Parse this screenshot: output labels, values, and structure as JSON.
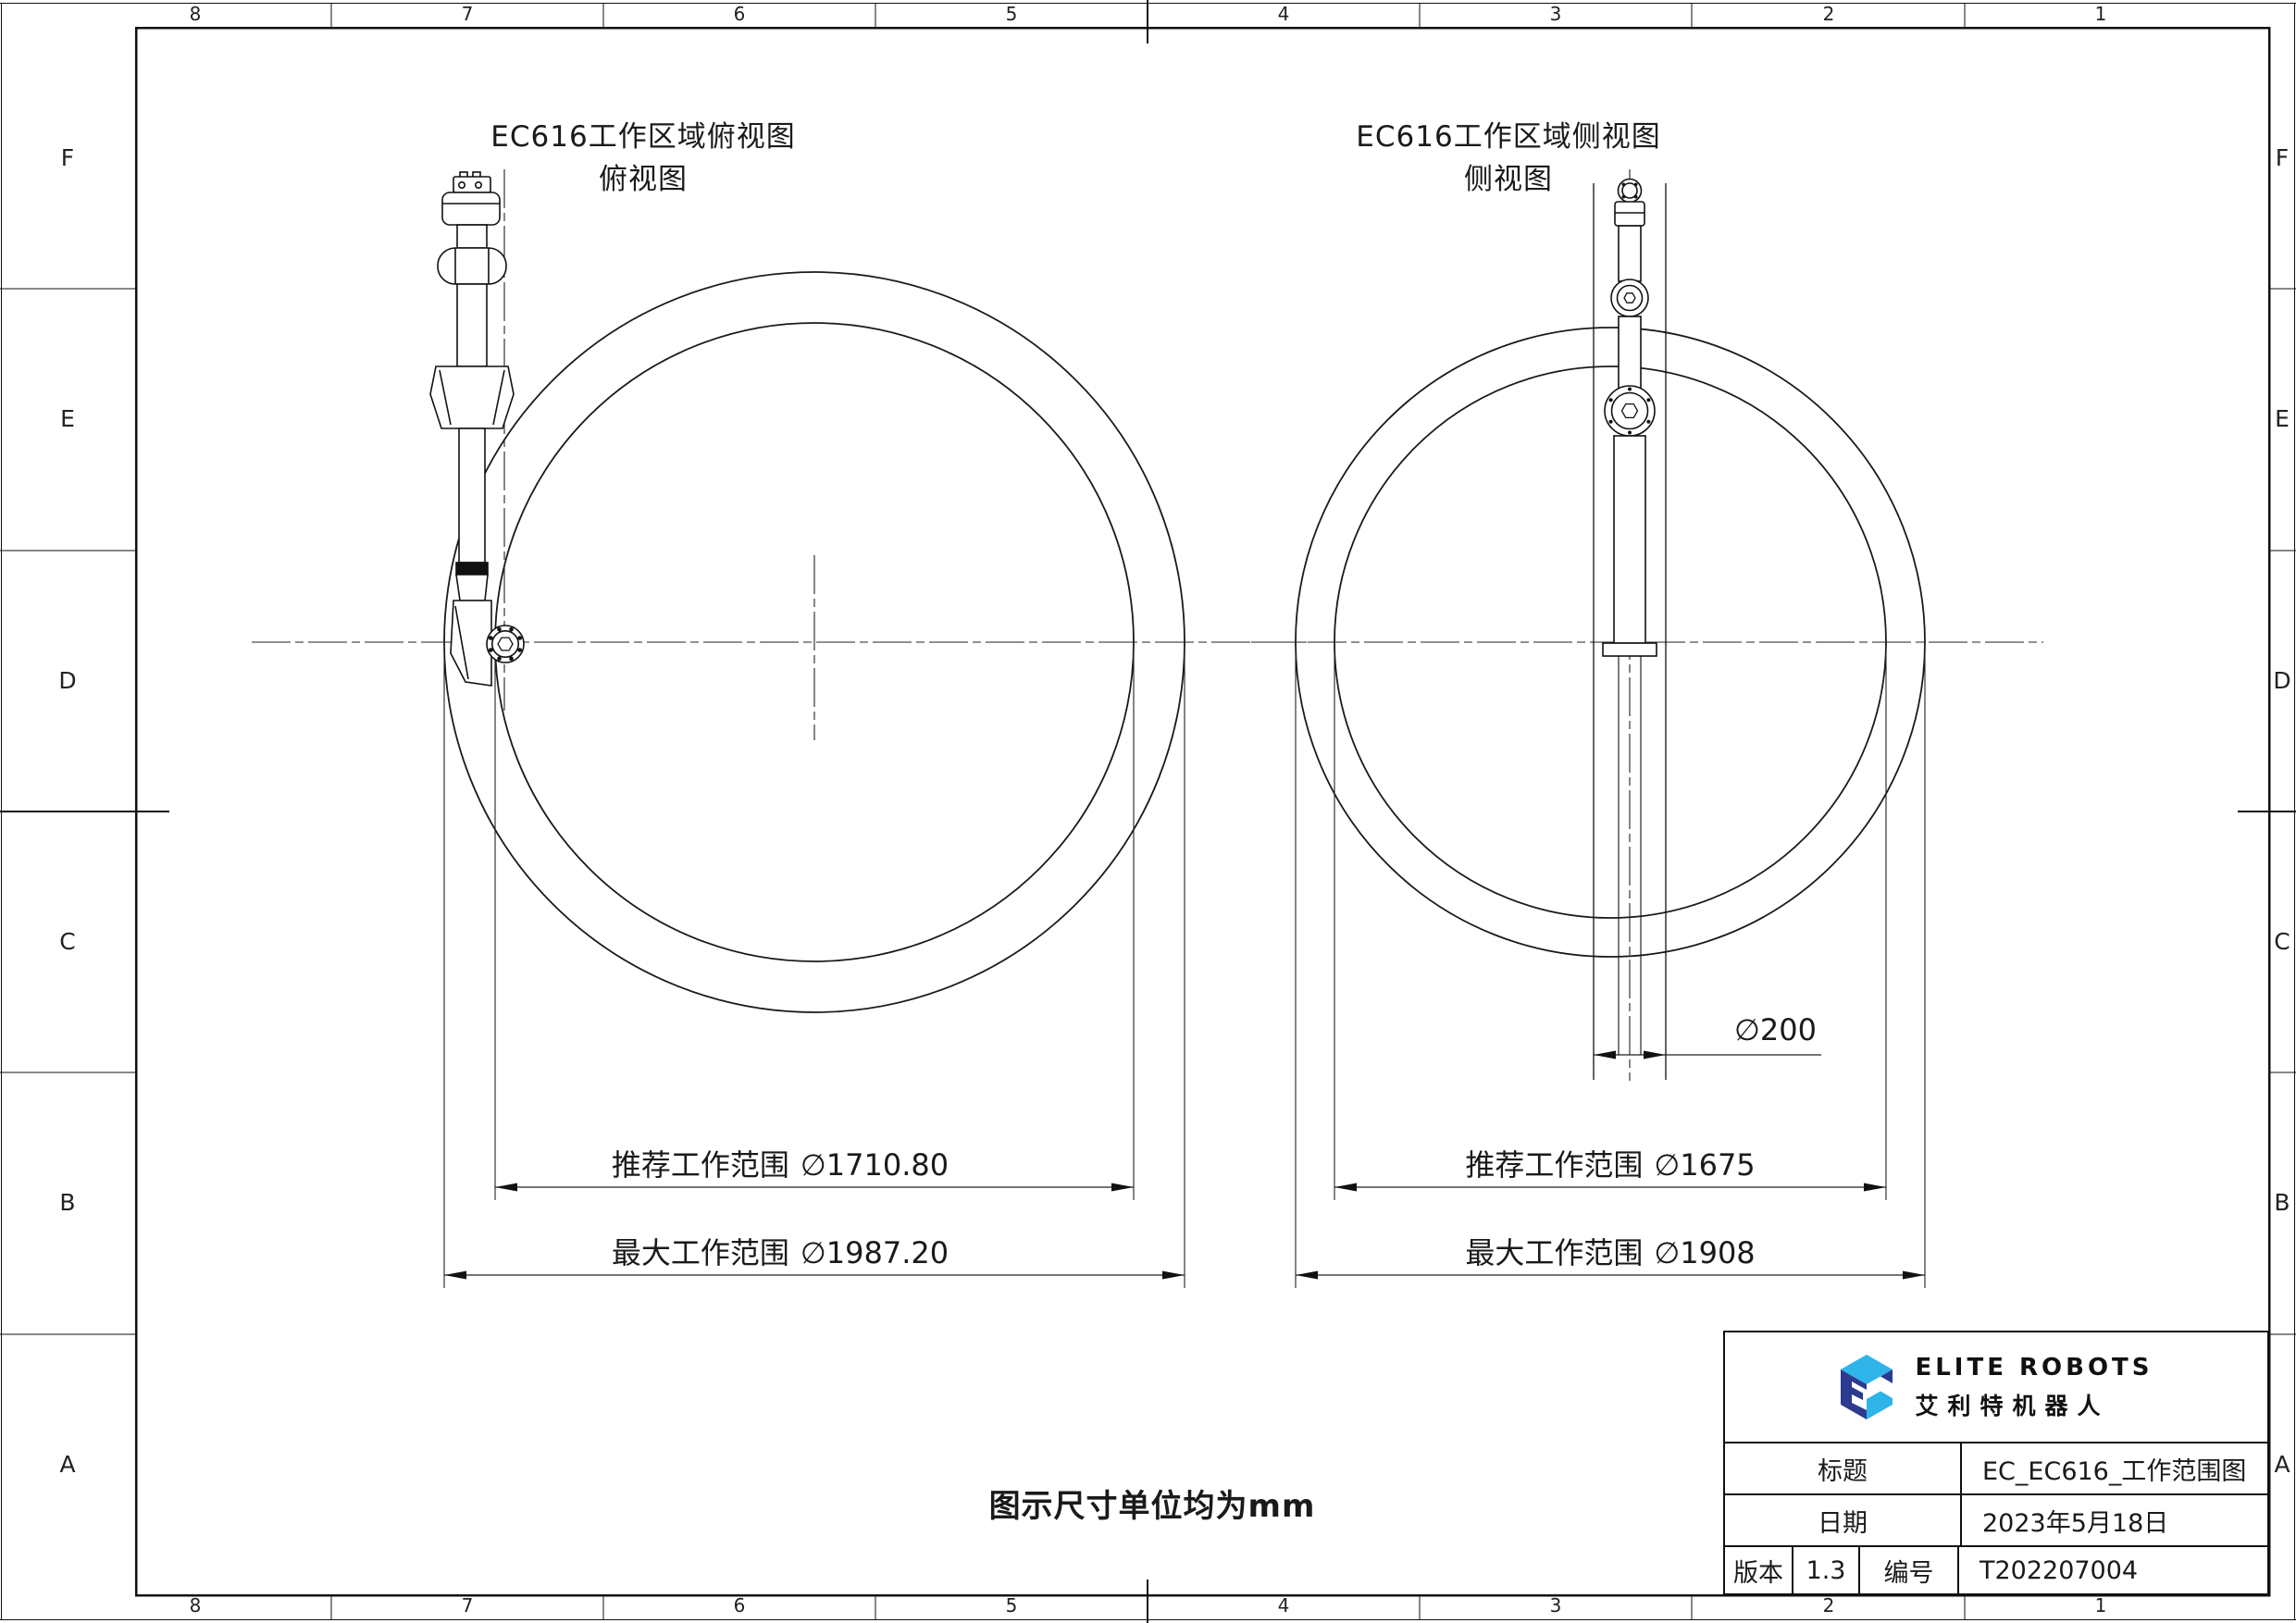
{
  "sheet": {
    "zones_top": [
      "8",
      "7",
      "6",
      "5",
      "4",
      "3",
      "2",
      "1"
    ],
    "zones_bottom": [
      "8",
      "7",
      "6",
      "5",
      "4",
      "3",
      "2",
      "1"
    ],
    "zones_left": [
      "F",
      "E",
      "D",
      "C",
      "B",
      "A"
    ],
    "zones_right": [
      "F",
      "E",
      "D",
      "C",
      "B",
      "A"
    ],
    "note": "图示尺寸单位均为mm"
  },
  "top_view": {
    "title": "EC616工作区域俯视图",
    "subtitle": "俯视图",
    "dim_recommended_label": "推荐工作范围",
    "dim_recommended_value": "∅1710.80",
    "dim_max_label": "最大工作范围",
    "dim_max_value": "∅1987.20"
  },
  "side_view": {
    "title": "EC616工作区域侧视图",
    "subtitle": "侧视图",
    "dim_recommended_label": "推荐工作范围",
    "dim_recommended_value": "∅1675",
    "dim_max_label": "最大工作范围",
    "dim_max_value": "∅1908",
    "dim_column_value": "∅200"
  },
  "title_block": {
    "brand_en": "ELITE ROBOTS",
    "brand_cn": "艾利特机器人",
    "title_label": "标题",
    "title_value": "EC_EC616_工作范围图",
    "date_label": "日期",
    "date_value": "2023年5月18日",
    "version_label": "版本",
    "version_value": "1.3",
    "number_label": "编号",
    "number_value": "T202207004"
  },
  "colors": {
    "line": "#1a1a1a",
    "logo_light_blue": "#2fb4e9",
    "logo_dark_blue": "#2c3a8f"
  }
}
